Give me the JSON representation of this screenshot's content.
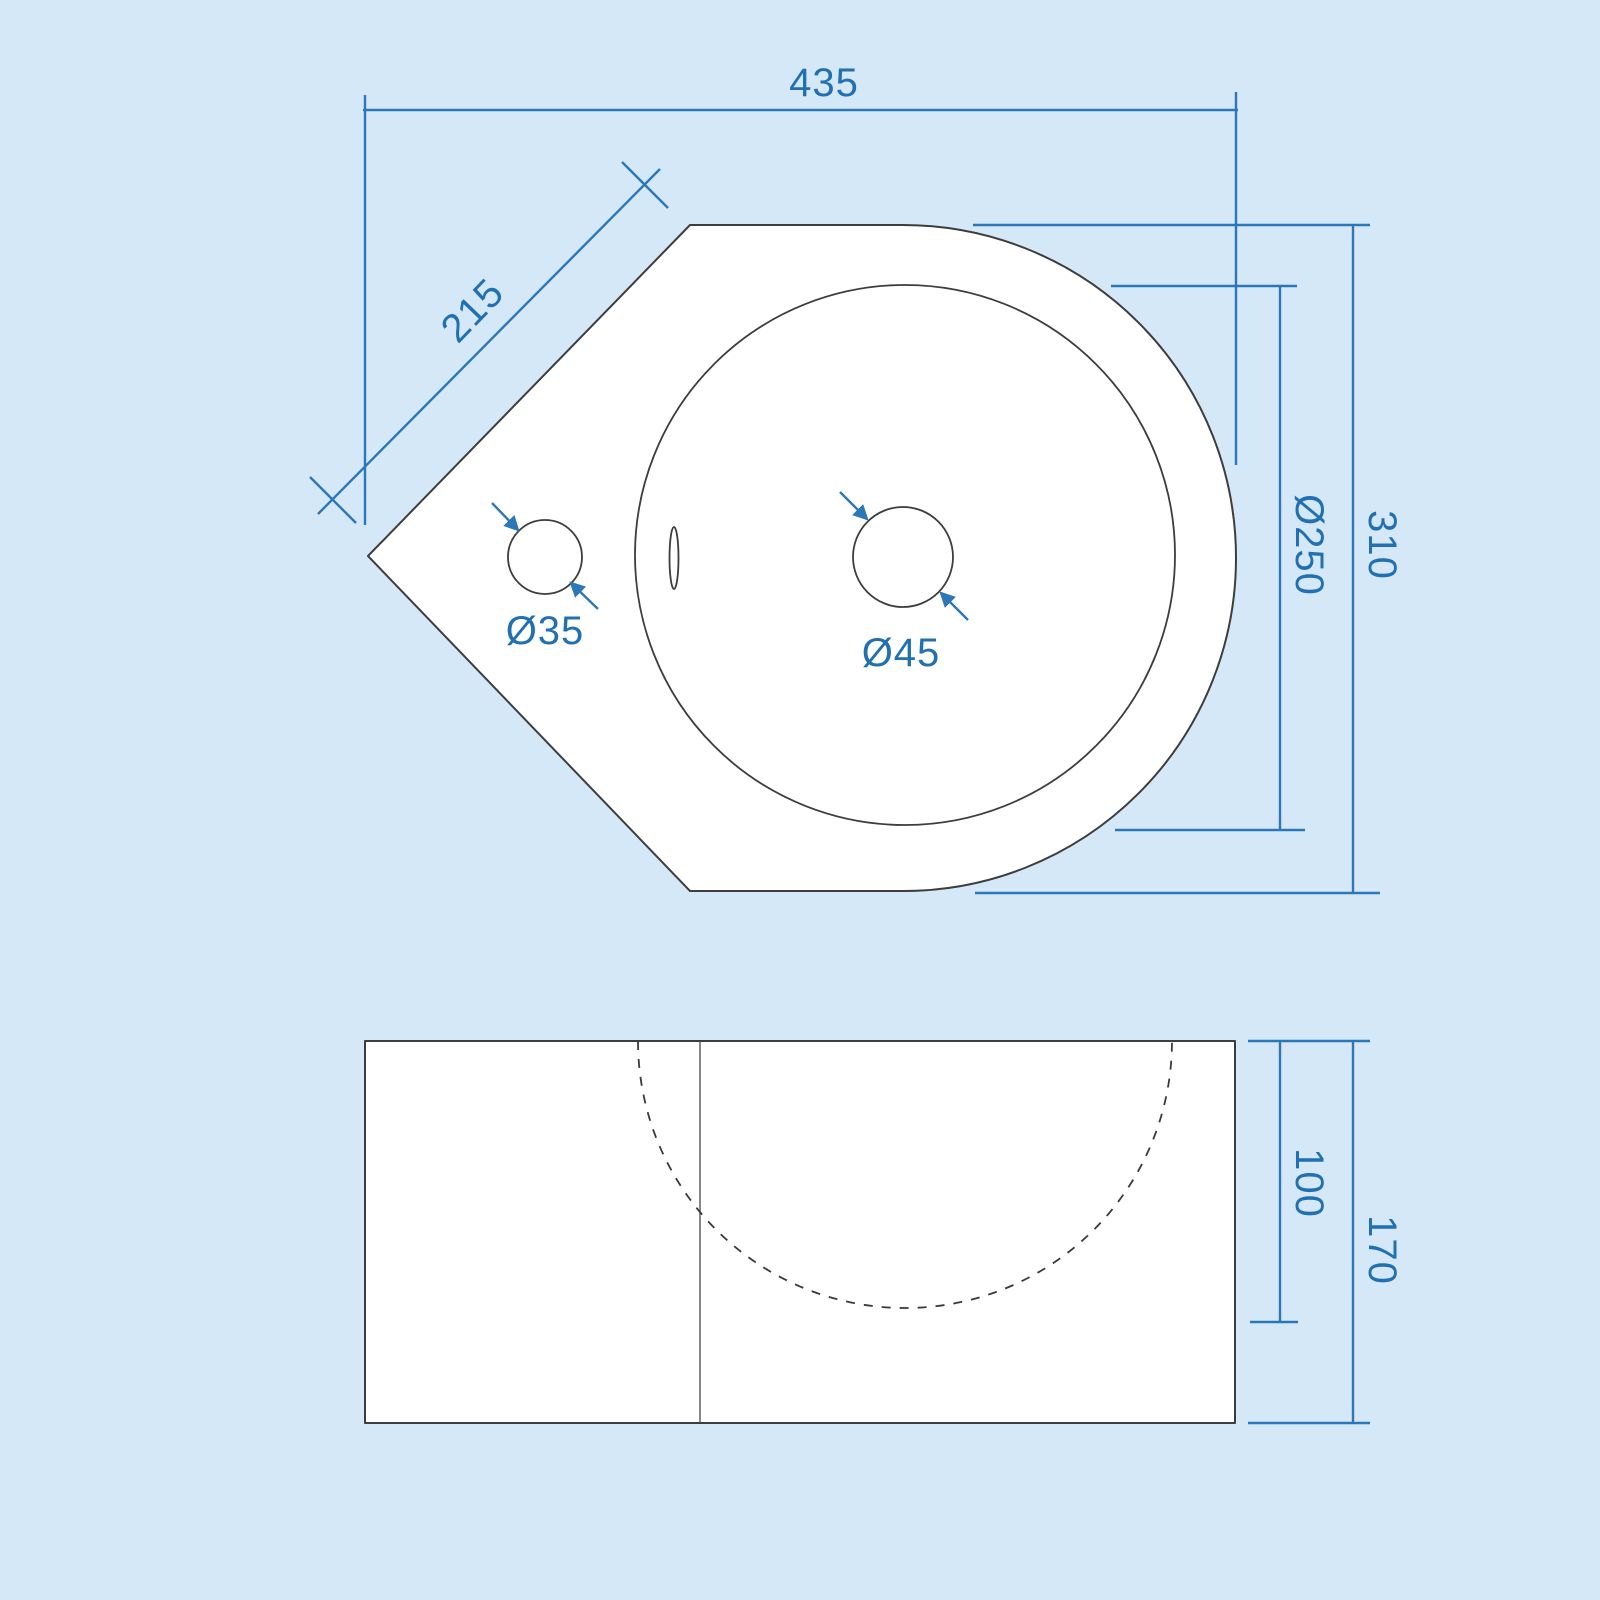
{
  "drawing": {
    "type": "technical-dimension-drawing",
    "subject": "corner cloakroom basin",
    "colors": {
      "background": "#d5e8f8",
      "dimension_blue": "#2b77b8",
      "label_blue": "#2170b2",
      "outline_gray": "#3d3d3d",
      "shape_fill": "#ffffff"
    },
    "top_view": {
      "dim_overall_width": "435",
      "dim_corner_edge": "215",
      "dim_bowl_diameter": "Ø250",
      "dim_overall_depth": "310",
      "dim_tap_hole": "Ø35",
      "dim_waste_hole": "Ø45"
    },
    "front_view": {
      "dim_bowl_depth": "100",
      "dim_overall_height": "170"
    }
  }
}
